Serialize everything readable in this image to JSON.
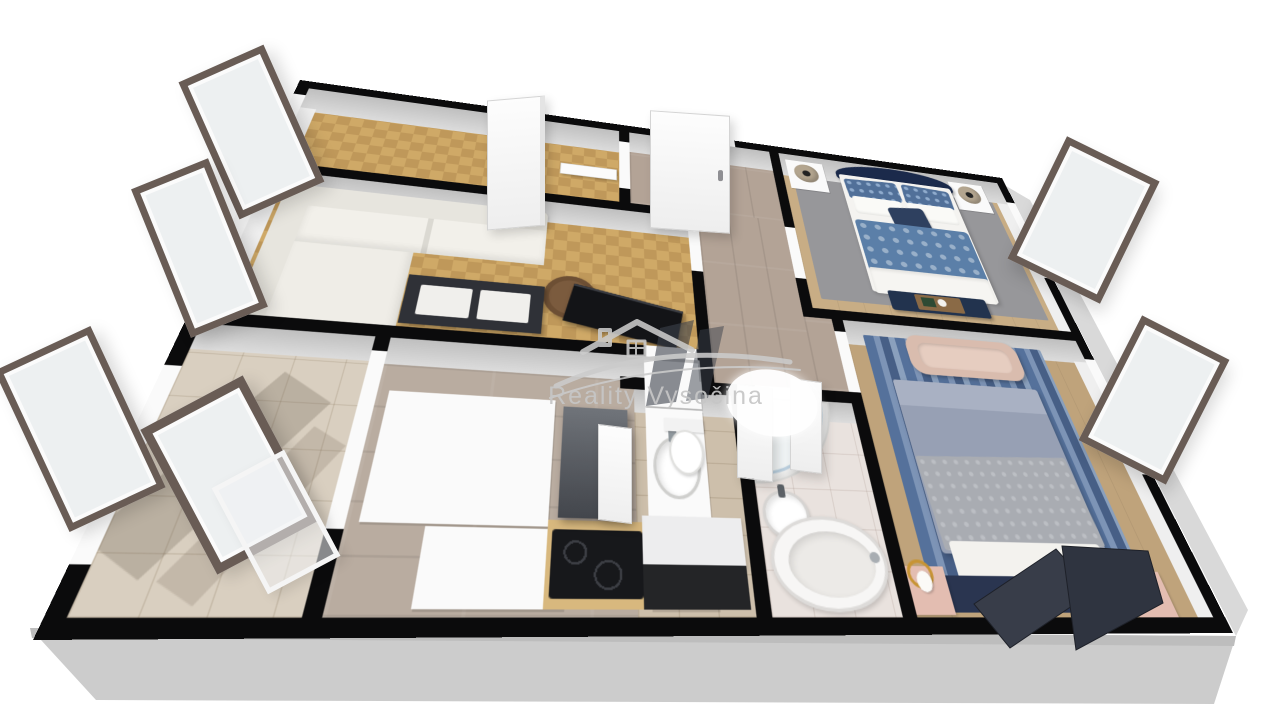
{
  "watermark": {
    "brand": "Reality Vysočina",
    "logo": "house-roof-with-chimney-window-and-swoosh",
    "color": "#c9c9c9"
  },
  "palette": {
    "background": "#ffffff",
    "wall_top": "#0b0b0c",
    "wall_face": "#d6d6d6",
    "plinth": "#cfcfcf",
    "parquet": "#c8a162",
    "laminate": "#b3a396",
    "balcony_tile": "#d9cfc0",
    "bathroom_tile": "#e9e2de",
    "bedroom_wood": "#c8ad85",
    "navy": "#1d2c4d",
    "duvet_blue": "#5b7fa8",
    "duvet_gray": "#98a1b5",
    "blush": "#d9bcae",
    "window_frame": "#695c55",
    "gold": "#c79434"
  },
  "floorplan": {
    "projection": "3d-perspective-dollhouse",
    "rooms": [
      {
        "id": "room-upper-left",
        "floor": "parquet",
        "furniture": []
      },
      {
        "id": "living-room",
        "floor": "parquet",
        "furniture": [
          "corner-sofa",
          "round-coffee-table",
          "tv-lowboard",
          "flat-tv"
        ]
      },
      {
        "id": "entry-hall",
        "floor": "laminate",
        "furniture": [
          "entry-door"
        ]
      },
      {
        "id": "kitchen",
        "floor": "laminate",
        "furniture": [
          "tall-cabinet",
          "counter-with-sink",
          "island-cabinet",
          "range-hood",
          "induction-cooktop",
          "wood-worktop"
        ]
      },
      {
        "id": "balcony",
        "floor": "ceramic-tile",
        "furniture": [
          "open-balcony-door"
        ]
      },
      {
        "id": "wc",
        "floor": "tile",
        "furniture": [
          "toilet",
          "storage-cabinet"
        ]
      },
      {
        "id": "bathroom",
        "floor": "tile",
        "furniture": [
          "corner-shower",
          "round-washbasin",
          "oval-bathtub"
        ]
      },
      {
        "id": "bedroom-upper",
        "floor": "wood",
        "furniture": [
          "double-bed-navy",
          "patterned-blue-duvet",
          "nightstand-left",
          "nightstand-right",
          "table-lamp-left",
          "table-lamp-right",
          "bench-with-tray",
          "gray-rug"
        ]
      },
      {
        "id": "bedroom-lower",
        "floor": "wood",
        "furniture": [
          "double-bed-gray",
          "quilted-throw",
          "dark-headboard-panels",
          "blush-bench",
          "pink-nightstand-left",
          "pink-nightstand-right",
          "gold-lamp-left",
          "gold-lamp-right",
          "blue-striped-rug"
        ]
      }
    ],
    "window_count": 7,
    "door_count": 8
  }
}
